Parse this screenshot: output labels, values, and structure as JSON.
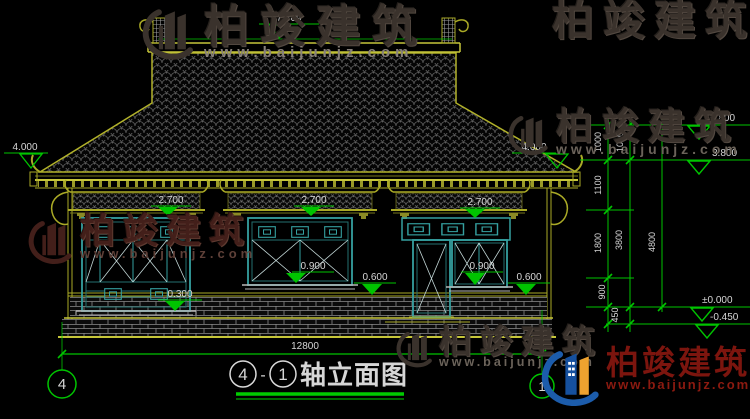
{
  "colors": {
    "background": "#000000",
    "dimension_green": "#00c400",
    "building_olive": "#aaaa26",
    "window_teal": "#35a0a0",
    "watermark_red": "#7c150e",
    "logo_blue": "#1c5cab",
    "logo_orange": "#eea22f"
  },
  "watermark": {
    "brand": "柏竣建筑",
    "url": "www.baijunjz.com"
  },
  "title": {
    "axis_start": "4",
    "separator": "-",
    "axis_end": "1",
    "name": "轴立面图"
  },
  "axes": {
    "left_bubble": "4",
    "right_bubble": "1"
  },
  "levels": {
    "ridge": "7.469",
    "eave_left": "4.000",
    "eave_right": "4.000",
    "roof_upper": "4.800",
    "roof_lower": "3.800",
    "ground": "±0.000",
    "below_ground": "-0.450",
    "lintel_w1": "2.700",
    "lintel_w2": "2.700",
    "lintel_door": "2.700",
    "sill_w1": "0.300",
    "sill_w2": "0.900",
    "sill_w3": "0.900",
    "plinth_left": "0.600",
    "plinth_right": "0.600"
  },
  "vertical_dims": {
    "seg_1000_a": "1000",
    "seg_1000_b": "1000",
    "seg_1100": "1100",
    "seg_1800": "1800",
    "seg_900": "900",
    "seg_450": "450",
    "total_3800": "3800",
    "total_4800": "4800"
  },
  "horizontal_dims": {
    "total_width": "12800"
  }
}
